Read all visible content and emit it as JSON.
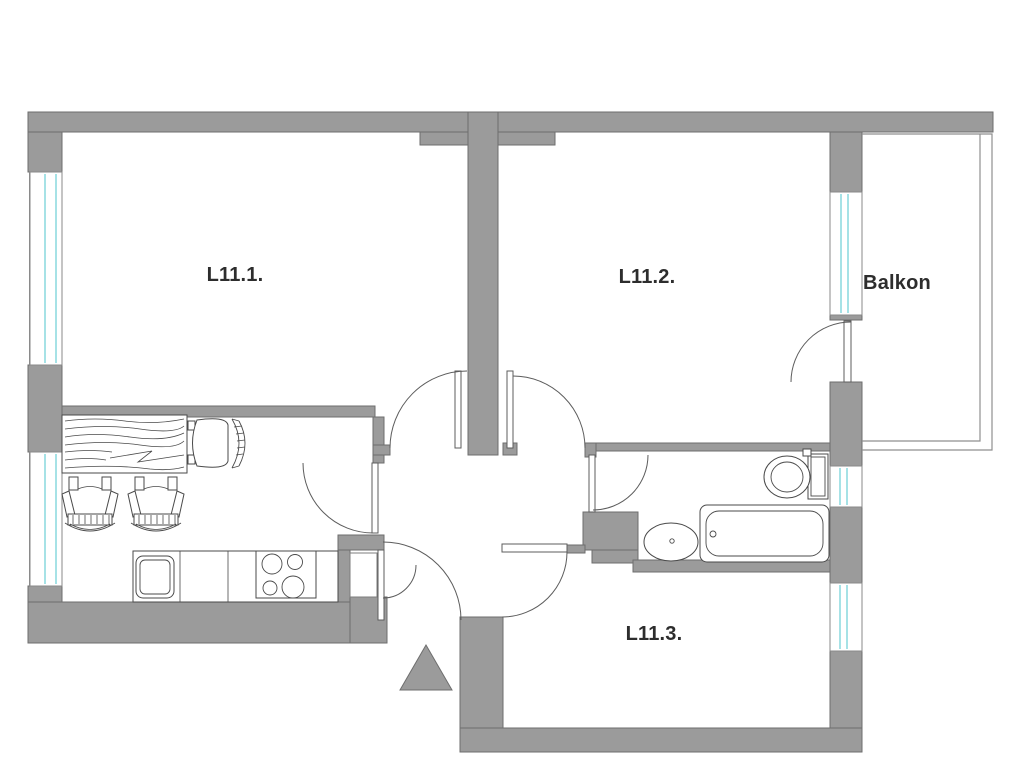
{
  "floor_plan": {
    "rooms": [
      {
        "id": "room-1",
        "label": "L11.1."
      },
      {
        "id": "room-2",
        "label": "L11.2."
      },
      {
        "id": "room-3",
        "label": "L11.3."
      },
      {
        "id": "balcony",
        "label": "Balkon"
      }
    ],
    "colors": {
      "wall": "#9b9b9b",
      "wall_edge": "#6e6e6e",
      "drawing_line": "#5c5c5c",
      "furniture_line": "#4a4a4a",
      "window_glass": "#a6e2e6",
      "window_frame": "#8a8a8a",
      "label_text": "#2d2d2d",
      "floor": "#ffffff"
    },
    "fixtures": [
      "dining-table",
      "chair",
      "chair",
      "chair",
      "kitchen-counter",
      "kitchen-sink",
      "stove-burners",
      "storage-niche",
      "toilet",
      "bathtub",
      "washbasin",
      "entrance-triangle-marker"
    ],
    "opening_counts": {
      "doors": 7,
      "windows": 5
    }
  }
}
